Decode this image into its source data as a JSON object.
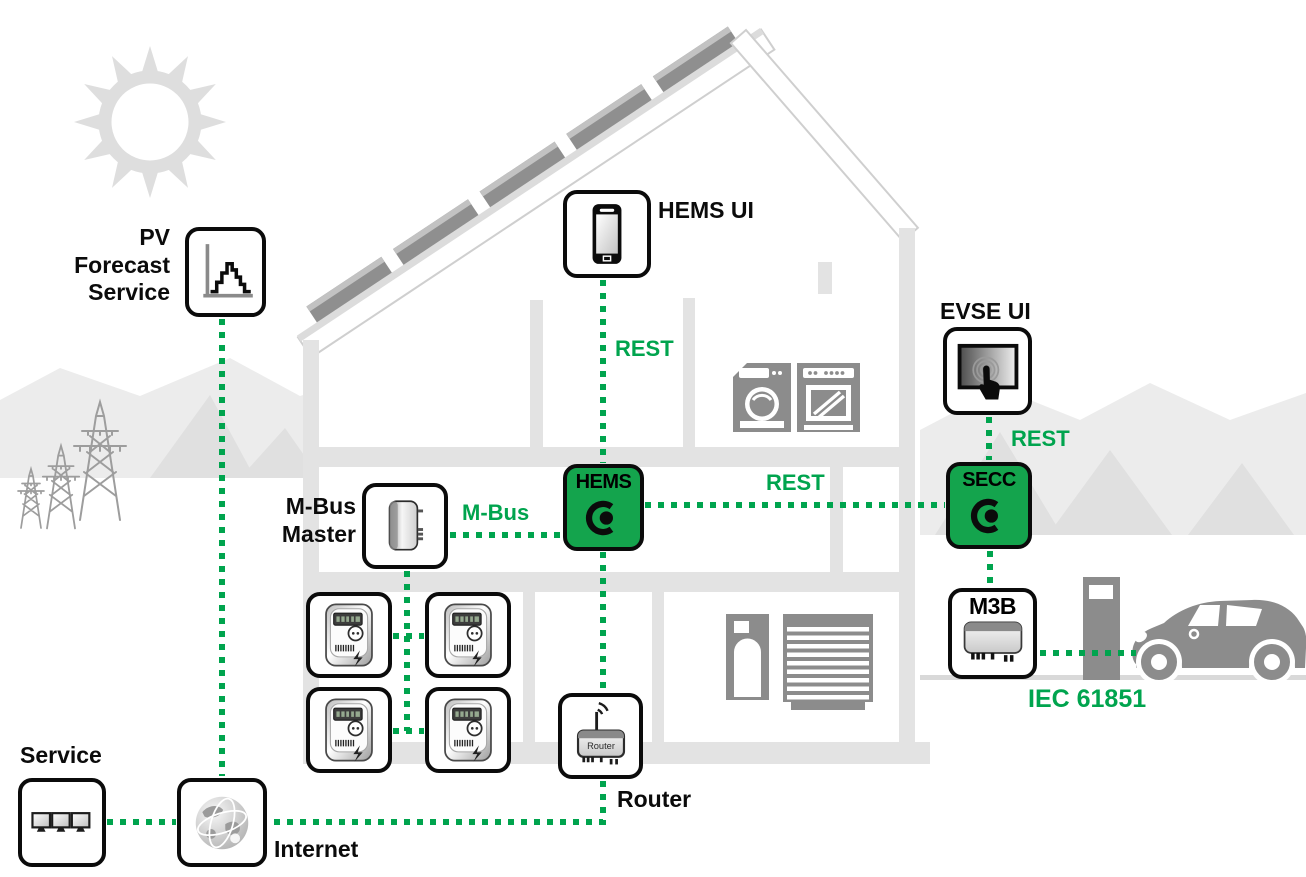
{
  "colors": {
    "accent_green": "#00A44E",
    "controller_box_green": "#14A44D",
    "structure_gray": "#e3e3e3",
    "appliance_gray": "#8c8c8c",
    "box_border_black": "#0b0b0b"
  },
  "nodes": {
    "pv_forecast": {
      "label": "PV\nForecast\nService",
      "icon": "forecast-chart-icon"
    },
    "hems_ui": {
      "label": "HEMS UI",
      "icon": "smartphone-icon"
    },
    "evse_ui": {
      "label": "EVSE UI",
      "icon": "touchscreen-icon"
    },
    "mbus_master": {
      "label": "M-Bus\nMaster",
      "icon": "wall-device-icon"
    },
    "hems": {
      "title": "HEMS",
      "icon": "c-dot-logo"
    },
    "secc": {
      "title": "SECC",
      "icon": "c-dot-logo"
    },
    "m3b": {
      "title": "M3B",
      "icon": "din-module-icon"
    },
    "router": {
      "label": "Router",
      "device_text": "Router",
      "icon": "wifi-router-icon"
    },
    "internet": {
      "label": "Internet",
      "icon": "globe-icon"
    },
    "service": {
      "label": "Service",
      "icon": "monitors-icon"
    },
    "meters": {
      "icon": "electricity-meter-icon",
      "count": 4
    }
  },
  "connections": {
    "hemsui_hems": "REST",
    "hems_secc": "REST",
    "evseui_secc": "REST",
    "mbusmaster_hems": "M-Bus",
    "m3b_ev": "IEC 61851"
  },
  "scene": {
    "background_items": [
      "sun",
      "solar-panel-roof",
      "house-cross-section",
      "power-pylons",
      "hills",
      "washing-machine",
      "oven",
      "water-heater",
      "garage-door",
      "charging-station",
      "electric-car"
    ]
  }
}
